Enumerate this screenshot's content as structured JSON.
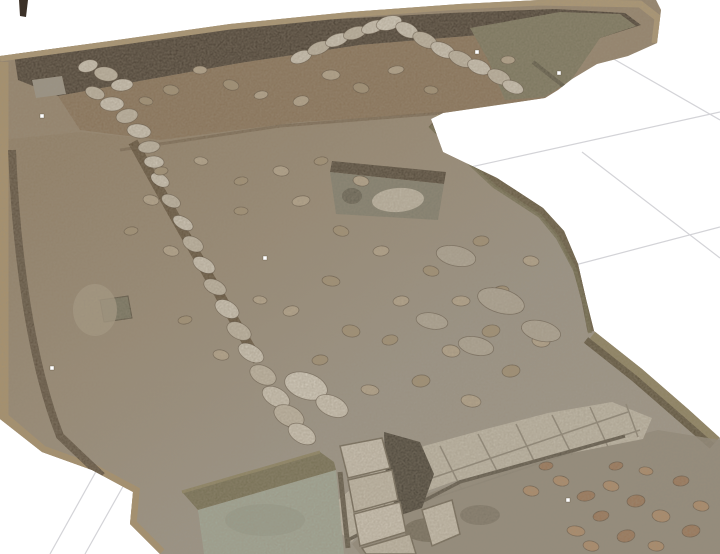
{
  "viewport": {
    "width": 720,
    "height": 554,
    "background": "#ffffff",
    "description": "photogrammetry-3d-model-of-archaeological-excavation-trench"
  },
  "palette": {
    "grid": "#d3d3d7",
    "soilBase": "#94826a",
    "topFloor": "#846c50",
    "lip": "#b19a72",
    "lipLower": "#ab9269",
    "shadowDark": "#3b3126",
    "clayGreen": "#757258",
    "grooveDark": "#55523f",
    "baulkOlive": "#5c5138",
    "baulkGrass": "#6a6747",
    "baulkKhaki": "#8c815c",
    "baulkEdgeDark": "#544a33",
    "baulkLip": "#a79670",
    "wallGroove": "#57462f",
    "leftGroove": "#4e4030",
    "cutBand": "#453b2d",
    "cutFill": "#7d7c6c",
    "cutStone": "#c6bfae",
    "pave": "#c7c1b1",
    "paveJoint": "#8b8577",
    "paveEdge": "#534d41",
    "stepDark": "#3a352b",
    "block": "#d3ccbd",
    "blockJoint": "#6b6353",
    "pond": "#a2ac9c",
    "pondSlope": "#6f6a4c",
    "pondLip": "#8a815c",
    "siltLow": "#8f887a",
    "slab": "#9b968a",
    "pitGreen": "#6f6e5a",
    "poleDark": "#3c3128",
    "marker": "#ffffff",
    "stoneStroke": "rgba(60,48,34,0.55)",
    "stoneColors": [
      "#d6cfc0",
      "#c6bdab",
      "#ddd7c9",
      "#b8a88e",
      "#a29072",
      "#b3ab9b",
      "#b08a66",
      "#9a7252"
    ]
  },
  "grid": {
    "lines": [
      {
        "name": "grid-line-a1",
        "x1": 430,
        "y1": 176,
        "x2": 720,
        "y2": 112
      },
      {
        "name": "grid-line-a2",
        "x1": 556,
        "y1": 270,
        "x2": 720,
        "y2": 227
      },
      {
        "name": "grid-line-b1",
        "x1": 598,
        "y1": 50,
        "x2": 720,
        "y2": 120
      },
      {
        "name": "grid-line-b2",
        "x1": 582,
        "y1": 152,
        "x2": 720,
        "y2": 258
      },
      {
        "name": "grid-line-b3",
        "x1": 118,
        "y1": 432,
        "x2": 50,
        "y2": 554
      },
      {
        "name": "grid-line-b4",
        "x1": 148,
        "y1": 442,
        "x2": 85,
        "y2": 554
      }
    ]
  },
  "markers": [
    {
      "x": 42,
      "y": 116
    },
    {
      "x": 265,
      "y": 258
    },
    {
      "x": 477,
      "y": 52
    },
    {
      "x": 559,
      "y": 73
    },
    {
      "x": 568,
      "y": 500
    },
    {
      "x": 52,
      "y": 368
    }
  ],
  "stones": [
    [
      88,
      66,
      10,
      6,
      -15,
      0
    ],
    [
      106,
      74,
      12,
      7,
      10,
      1
    ],
    [
      122,
      85,
      11,
      6,
      -5,
      0
    ],
    [
      95,
      93,
      10,
      6,
      20,
      1
    ],
    [
      112,
      104,
      12,
      7,
      0,
      0
    ],
    [
      127,
      116,
      11,
      7,
      -12,
      1
    ],
    [
      139,
      131,
      12,
      7,
      8,
      0
    ],
    [
      149,
      147,
      11,
      6,
      -6,
      1
    ],
    [
      154,
      162,
      10,
      6,
      4,
      0
    ],
    [
      160,
      180,
      10,
      6,
      30,
      0
    ],
    [
      171,
      201,
      10,
      6,
      25,
      1
    ],
    [
      183,
      223,
      11,
      6,
      30,
      0
    ],
    [
      193,
      244,
      11,
      7,
      28,
      1
    ],
    [
      204,
      265,
      12,
      7,
      30,
      0
    ],
    [
      215,
      287,
      12,
      7,
      26,
      1
    ],
    [
      227,
      309,
      13,
      8,
      30,
      0
    ],
    [
      239,
      331,
      13,
      8,
      28,
      1
    ],
    [
      251,
      353,
      14,
      8,
      30,
      0
    ],
    [
      263,
      375,
      14,
      9,
      27,
      1
    ],
    [
      276,
      397,
      15,
      9,
      30,
      0
    ],
    [
      289,
      416,
      16,
      10,
      26,
      1
    ],
    [
      302,
      434,
      15,
      9,
      30,
      0
    ],
    [
      306,
      386,
      22,
      13,
      18,
      2
    ],
    [
      332,
      406,
      17,
      10,
      24,
      0
    ],
    [
      301,
      57,
      11,
      6,
      -20,
      0
    ],
    [
      319,
      48,
      12,
      6,
      -22,
      1
    ],
    [
      337,
      40,
      12,
      6,
      -20,
      0
    ],
    [
      355,
      33,
      12,
      6,
      -18,
      1
    ],
    [
      373,
      27,
      12,
      6,
      -20,
      0
    ],
    [
      389,
      23,
      13,
      7,
      -15,
      2
    ],
    [
      407,
      30,
      12,
      7,
      25,
      0
    ],
    [
      425,
      40,
      13,
      7,
      25,
      1
    ],
    [
      443,
      50,
      13,
      7,
      24,
      0
    ],
    [
      461,
      59,
      13,
      7,
      25,
      1
    ],
    [
      479,
      67,
      12,
      7,
      22,
      0
    ],
    [
      499,
      77,
      12,
      7,
      24,
      1
    ],
    [
      513,
      87,
      11,
      6,
      22,
      0
    ],
    [
      200,
      70,
      7,
      4,
      0,
      3
    ],
    [
      231,
      85,
      8,
      5,
      15,
      4
    ],
    [
      261,
      95,
      7,
      4,
      -10,
      3
    ],
    [
      171,
      90,
      8,
      5,
      8,
      4
    ],
    [
      331,
      75,
      9,
      5,
      0,
      3
    ],
    [
      361,
      88,
      8,
      5,
      12,
      4
    ],
    [
      396,
      70,
      8,
      4,
      -8,
      3
    ],
    [
      431,
      90,
      7,
      4,
      6,
      4
    ],
    [
      301,
      101,
      8,
      5,
      -14,
      3
    ],
    [
      146,
      101,
      7,
      4,
      10,
      4
    ],
    [
      508,
      60,
      7,
      4,
      0,
      3
    ],
    [
      151,
      200,
      8,
      5,
      10,
      3
    ],
    [
      131,
      231,
      7,
      4,
      -8,
      4
    ],
    [
      171,
      251,
      8,
      5,
      12,
      3
    ],
    [
      241,
      211,
      7,
      4,
      0,
      4
    ],
    [
      301,
      201,
      9,
      5,
      -10,
      3
    ],
    [
      341,
      231,
      8,
      5,
      14,
      4
    ],
    [
      381,
      251,
      8,
      5,
      -6,
      3
    ],
    [
      331,
      281,
      9,
      5,
      8,
      4
    ],
    [
      291,
      311,
      8,
      5,
      -12,
      3
    ],
    [
      351,
      331,
      9,
      6,
      10,
      4
    ],
    [
      401,
      301,
      8,
      5,
      -8,
      3
    ],
    [
      431,
      271,
      8,
      5,
      12,
      4
    ],
    [
      461,
      301,
      9,
      5,
      0,
      3
    ],
    [
      491,
      331,
      9,
      6,
      -10,
      4
    ],
    [
      451,
      351,
      9,
      6,
      8,
      3
    ],
    [
      421,
      381,
      9,
      6,
      -6,
      4
    ],
    [
      471,
      401,
      10,
      6,
      10,
      3
    ],
    [
      511,
      371,
      9,
      6,
      -8,
      4
    ],
    [
      541,
      341,
      9,
      6,
      6,
      3
    ],
    [
      501,
      291,
      8,
      5,
      -10,
      4
    ],
    [
      531,
      261,
      8,
      5,
      8,
      3
    ],
    [
      481,
      241,
      8,
      5,
      -6,
      4
    ],
    [
      361,
      181,
      8,
      5,
      10,
      3
    ],
    [
      321,
      161,
      7,
      4,
      -8,
      4
    ],
    [
      281,
      171,
      8,
      5,
      6,
      3
    ],
    [
      241,
      181,
      7,
      4,
      -10,
      4
    ],
    [
      201,
      161,
      7,
      4,
      8,
      3
    ],
    [
      161,
      171,
      7,
      4,
      -6,
      4
    ],
    [
      221,
      355,
      8,
      5,
      12,
      3
    ],
    [
      185,
      320,
      7,
      4,
      -9,
      4
    ],
    [
      260,
      300,
      7,
      4,
      7,
      3
    ],
    [
      390,
      340,
      8,
      5,
      -11,
      4
    ],
    [
      370,
      390,
      9,
      5,
      9,
      3
    ],
    [
      320,
      360,
      8,
      5,
      -7,
      4
    ],
    [
      456,
      256,
      20,
      10,
      12,
      5
    ],
    [
      501,
      301,
      24,
      12,
      16,
      5
    ],
    [
      541,
      331,
      20,
      10,
      14,
      5
    ],
    [
      476,
      346,
      18,
      9,
      12,
      5
    ],
    [
      432,
      321,
      16,
      8,
      10,
      5
    ],
    [
      561,
      481,
      8,
      5,
      10,
      6
    ],
    [
      586,
      496,
      9,
      5,
      -8,
      7
    ],
    [
      611,
      486,
      8,
      5,
      12,
      6
    ],
    [
      636,
      501,
      9,
      6,
      -6,
      7
    ],
    [
      661,
      516,
      9,
      6,
      10,
      6
    ],
    [
      601,
      516,
      8,
      5,
      -10,
      7
    ],
    [
      576,
      531,
      9,
      5,
      8,
      6
    ],
    [
      626,
      536,
      9,
      6,
      -12,
      7
    ],
    [
      656,
      546,
      8,
      5,
      6,
      6
    ],
    [
      691,
      531,
      9,
      6,
      -8,
      7
    ],
    [
      701,
      506,
      8,
      5,
      10,
      6
    ],
    [
      681,
      481,
      8,
      5,
      -6,
      7
    ],
    [
      646,
      471,
      7,
      4,
      8,
      6
    ],
    [
      616,
      466,
      7,
      4,
      -10,
      7
    ],
    [
      591,
      546,
      8,
      5,
      12,
      6
    ],
    [
      546,
      466,
      7,
      4,
      -6,
      7
    ],
    [
      531,
      491,
      8,
      5,
      9,
      6
    ]
  ]
}
